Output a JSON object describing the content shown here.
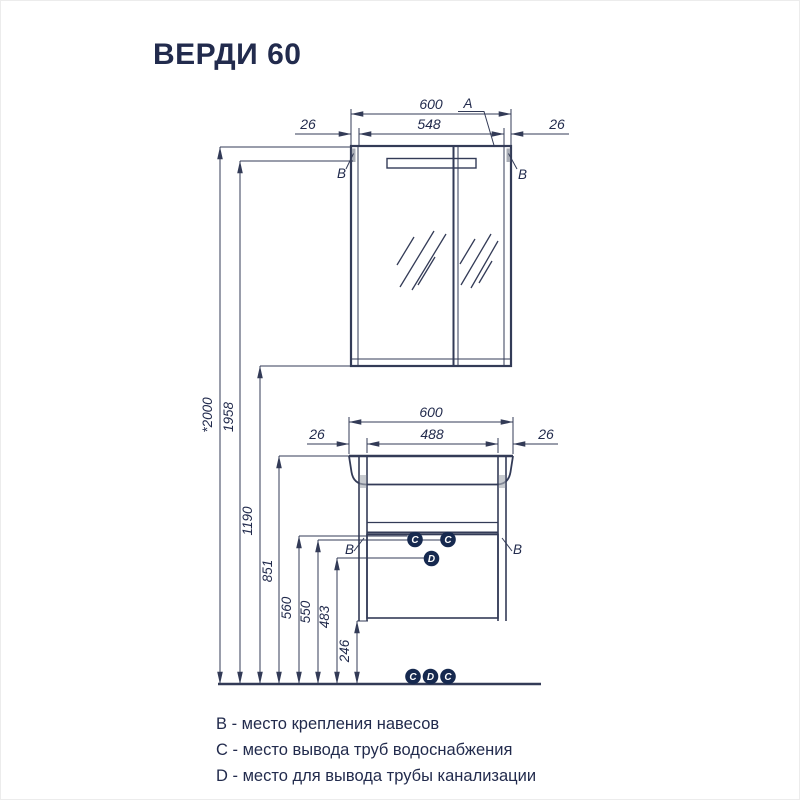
{
  "title": "ВЕРДИ 60",
  "colors": {
    "line": "#333b57",
    "text": "#222b4d",
    "marker_fill": "#16294f",
    "marker_text": "#ffffff",
    "hinge": "#a9adb6"
  },
  "mirror_cabinet": {
    "width_total": "600",
    "width_inner": "548",
    "offset_left": "26",
    "offset_right": "26",
    "label_a": "A",
    "label_b_left": "B",
    "label_b_right": "B"
  },
  "vanity": {
    "width_total": "600",
    "width_inner": "488",
    "offset_left": "26",
    "offset_right": "26",
    "label_b_left": "B",
    "label_b_right": "B",
    "pipes": {
      "c_left": "C",
      "c_right": "C",
      "d": "D"
    },
    "floor_pipes": {
      "c_left": "C",
      "d": "D",
      "c_right": "C"
    }
  },
  "heights": {
    "h2000": "*2000",
    "h1958": "1958",
    "h1190": "1190",
    "h851": "851",
    "h560": "560",
    "h550": "550",
    "h483": "483",
    "h246": "246"
  },
  "legend": {
    "b": "B - место крепления навесов",
    "c": "C - место вывода труб водоснабжения",
    "d": "D - место для вывода трубы канализации"
  }
}
